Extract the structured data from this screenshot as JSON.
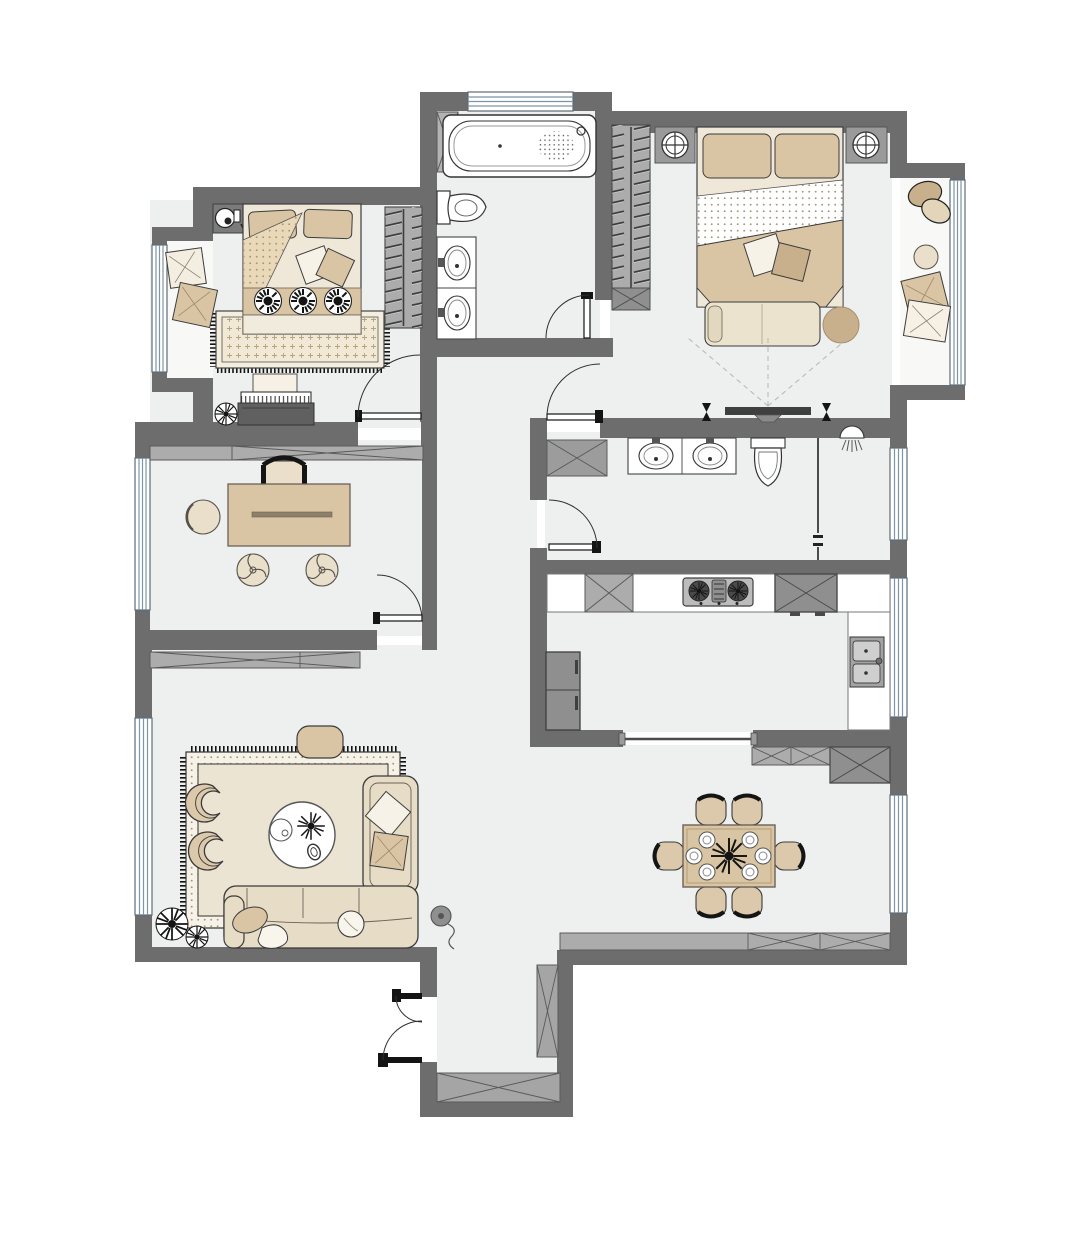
{
  "meta": {
    "title": "Apartment Floor Plan",
    "type": "architectural-floor-plan-top-view",
    "visible_text": ""
  },
  "palette": {
    "background": "#ffffff",
    "wall": "#6d6d6d",
    "floor": "#eef0ef",
    "balcony_floor": "#f8f8f6",
    "cabinet": "#acacac",
    "cabinet_dark": "#8f8f8f",
    "cabinet_line": "#5a5a5a",
    "appliance": "#606060",
    "beige": "#d9c5a4",
    "beige_dark": "#c8b08d",
    "cream": "#efe8d8",
    "sofa_cream": "#e7dcc6",
    "white": "#ffffff",
    "outline": "#3c3c3c",
    "window_line": "#7d95a4",
    "dash_line": "#b5b5b5",
    "ink": "#141414"
  },
  "rooms": [
    {
      "id": "second-bedroom",
      "name": "Second Bedroom",
      "furniture": [
        "double-bed",
        "pillows",
        "three-round-cushions",
        "area-rug",
        "wardrobe",
        "piano",
        "piano-bench",
        "plant",
        "corner-appliance"
      ]
    },
    {
      "id": "second-balcony",
      "name": "Second Bedroom Balcony",
      "furniture": [
        "floor-cushions"
      ]
    },
    {
      "id": "master-bathroom",
      "name": "Master Bathroom",
      "furniture": [
        "bathtub",
        "toilet",
        "double-sink-vanity",
        "storage-shelf"
      ]
    },
    {
      "id": "master-bedroom",
      "name": "Master Bedroom",
      "furniture": [
        "double-bed",
        "two-nightstands",
        "two-table-lamps",
        "foot-bench",
        "round-ottoman",
        "walk-in-wardrobe",
        "wall-tv"
      ]
    },
    {
      "id": "master-balcony",
      "name": "Master Balcony",
      "furniture": [
        "plants",
        "round-stool",
        "floor-cushions"
      ]
    },
    {
      "id": "study",
      "name": "Study",
      "furniture": [
        "desk",
        "desk-chair",
        "round-side-table",
        "two-stools",
        "built-in-cabinet"
      ]
    },
    {
      "id": "shared-bathroom",
      "name": "Shared Bathroom",
      "furniture": [
        "double-sink-vanity",
        "toilet",
        "shower-head",
        "glass-partition",
        "corner-cabinet"
      ]
    },
    {
      "id": "kitchen",
      "name": "Kitchen",
      "furniture": [
        "l-shaped-counter",
        "gas-stove",
        "refrigerator",
        "double-sink",
        "wall-cabinets",
        "sliding-opening"
      ]
    },
    {
      "id": "living-room",
      "name": "Living Room",
      "furniture": [
        "corner-sofa",
        "chaise",
        "round-coffee-table",
        "two-armchairs",
        "fringed-rug",
        "pouf",
        "plants",
        "floor-lamp",
        "low-cabinet"
      ]
    },
    {
      "id": "dining-room",
      "name": "Dining Room",
      "furniture": [
        "dining-table",
        "six-chairs",
        "six-place-settings",
        "centerpiece-plant",
        "sideboards"
      ]
    },
    {
      "id": "hallway",
      "name": "Hallway",
      "furniture": []
    },
    {
      "id": "entry",
      "name": "Entry",
      "furniture": [
        "double-swing-door",
        "shoe-cabinets"
      ]
    }
  ],
  "openings": {
    "windows": [
      "master-bath-north",
      "second-balcony-west",
      "master-balcony-east",
      "study-west",
      "living-west",
      "shared-bath-east",
      "kitchen-east",
      "dining-east"
    ],
    "doors": [
      "second-bedroom-door",
      "master-suite-door",
      "master-bath-door",
      "shared-bath-door",
      "study-door",
      "entry-double-door",
      "kitchen-sliding-opening"
    ]
  }
}
